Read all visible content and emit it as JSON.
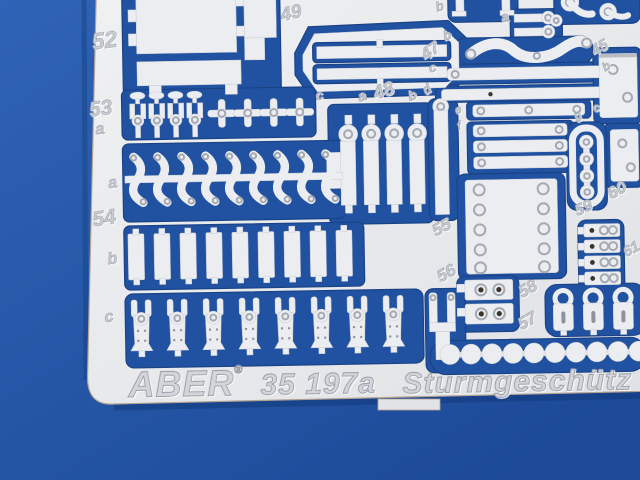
{
  "labels": {
    "n52": "52",
    "n53": "53",
    "a53": "a",
    "n49": "49",
    "b_top": "b",
    "a47": "a",
    "b47": "b",
    "n47": "47",
    "c47": "c",
    "n45": "45",
    "b45": "b",
    "c48": "c",
    "a48": "a",
    "n48": "48",
    "b48": "b",
    "d48": "d",
    "e47": "e",
    "f47": "f",
    "g47": "g",
    "c_mid": "c",
    "a54": "a",
    "n54": "54",
    "b54": "b",
    "c54": "c",
    "n55": "55",
    "n56": "56",
    "n57": "57",
    "n58": "58",
    "n59": "59",
    "n60": "60",
    "n61": "61"
  },
  "footer": {
    "brand": "ABER",
    "registered": "®",
    "set_number": "35 197a",
    "set_name": "Sturmgeschütz"
  },
  "colors": {
    "background_blue": "#2457a8",
    "pocket_blue": "#2152a2",
    "fret_silver": "#e7e8ea",
    "emboss_gray": "#cbcdd3",
    "hole_dark": "#3a342c"
  }
}
